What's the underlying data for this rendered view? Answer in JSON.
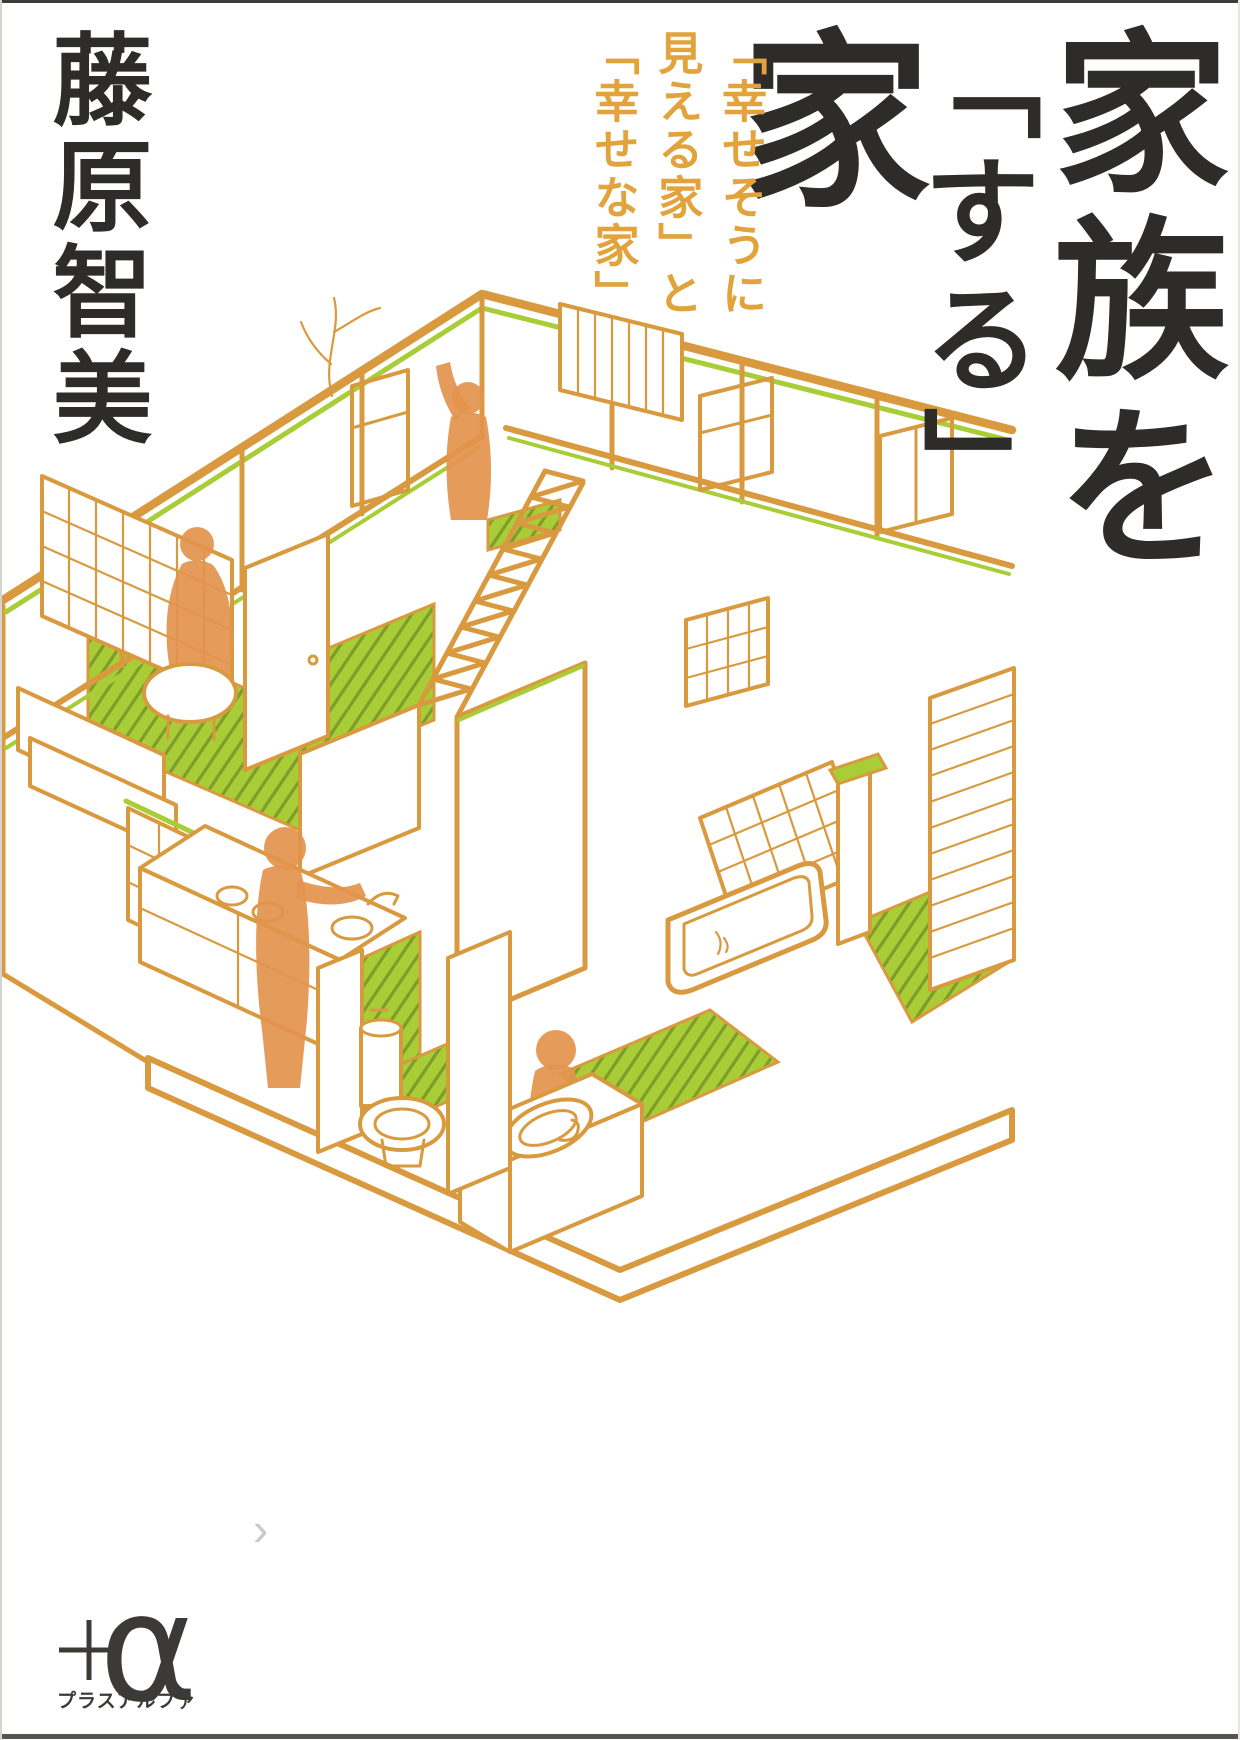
{
  "cover": {
    "author": "藤原智美",
    "title": {
      "full": "家族を「する」家",
      "column_right": "家族を",
      "column_left_small": "「する」",
      "column_left_large": "家"
    },
    "subtitle": {
      "columns": [
        "「幸せそうに",
        "見える家」と",
        "「幸せな家」"
      ]
    },
    "publisher_logo": {
      "alpha": "α",
      "caption": "プラスアルファ"
    }
  },
  "carousel": {
    "next_arrow": "›"
  },
  "colors": {
    "ink": "#2d2c28",
    "accent_gold": "#e2a33c",
    "line_orange": "#d99a3f",
    "lime": "#a9cd37",
    "lime_dark": "#7f9c2b",
    "silhouette": "#e3934e",
    "logo_dark": "#3b3a36",
    "chevron_gray": "#c9c9c9",
    "bg": "#ffffff"
  },
  "illustration": {
    "kind": "isometric-cutaway-house-line-art"
  }
}
